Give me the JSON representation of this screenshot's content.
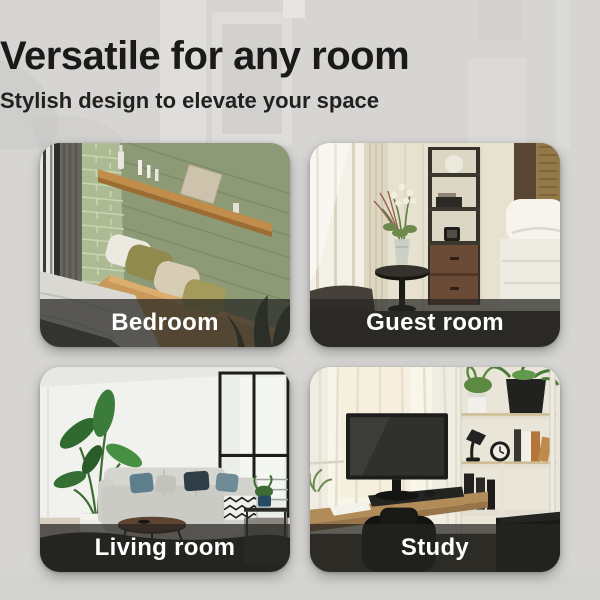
{
  "page": {
    "background_color": "#d6d5d3",
    "text_color": "#1b1a19"
  },
  "header": {
    "title": "Versatile for any room",
    "subtitle": "Stylish design to elevate your space"
  },
  "cards": [
    {
      "label": "Bedroom",
      "photo": "bed with olive and cream pillows against a sage-green shiplap wall, wooden ledge shelf with vases, candles and a canvas, window with gray curtain"
    },
    {
      "label": "Guest room",
      "photo": "hotel room with flowers in a glass vase on a round black side table, dark shelving tower with drawers, white bed and bright window"
    },
    {
      "label": "Living room",
      "photo": "white room with tall leafy plant in white pot, gray sectional sofa with blue pillows, round coffee table, dark rug and black-framed glass doors"
    },
    {
      "label": "Study",
      "photo": "wooden desk with monitor by a sheer-curtained window, white shelf unit with plants, lamp, alarm clock and books, black office chair"
    }
  ],
  "card_style": {
    "label_color": "#ffffff",
    "label_band_color": "rgba(38,37,35,0.72)"
  }
}
